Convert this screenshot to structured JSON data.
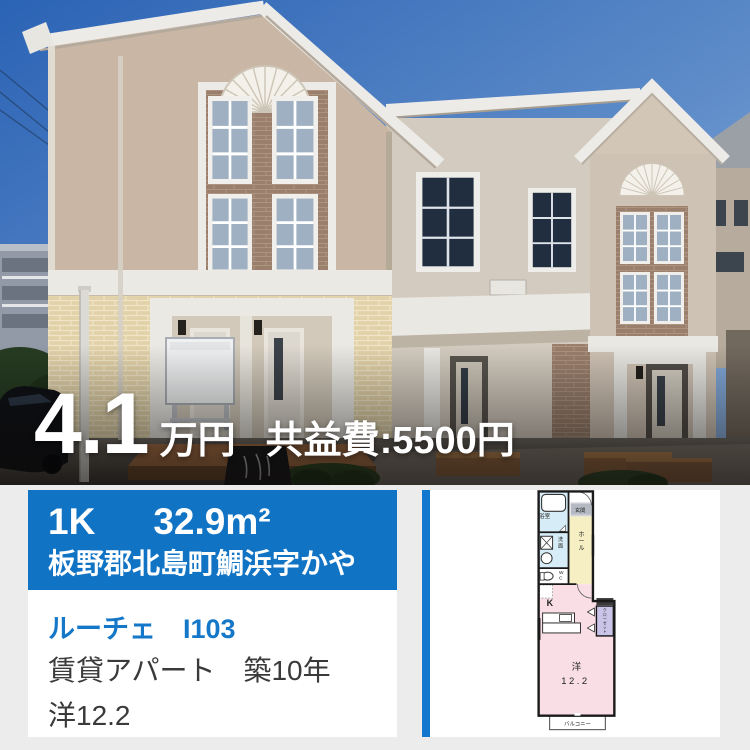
{
  "page": {
    "background": "#ececec",
    "accent_blue": "#1173c4"
  },
  "photo": {
    "price_value": "4.1",
    "price_unit": "万円",
    "maintenance_fee": "共益費:5500円"
  },
  "info_card": {
    "layout": "1K",
    "area": "32.9m²",
    "address": "板野郡北島町鯛浜字かや",
    "property_link": "ルーチェ　I103",
    "building_info": "賃貸アパート　築10年",
    "room_info": "洋12.2"
  },
  "floorplan": {
    "bath": "浴室",
    "entrance": "玄関",
    "hall": "ホール",
    "washroom": "洗面",
    "wc": "WC",
    "kitchen": "K",
    "closet": "クローゼット",
    "room_label": "洋",
    "room_size": "12.2",
    "balcony": "バルコニー"
  }
}
